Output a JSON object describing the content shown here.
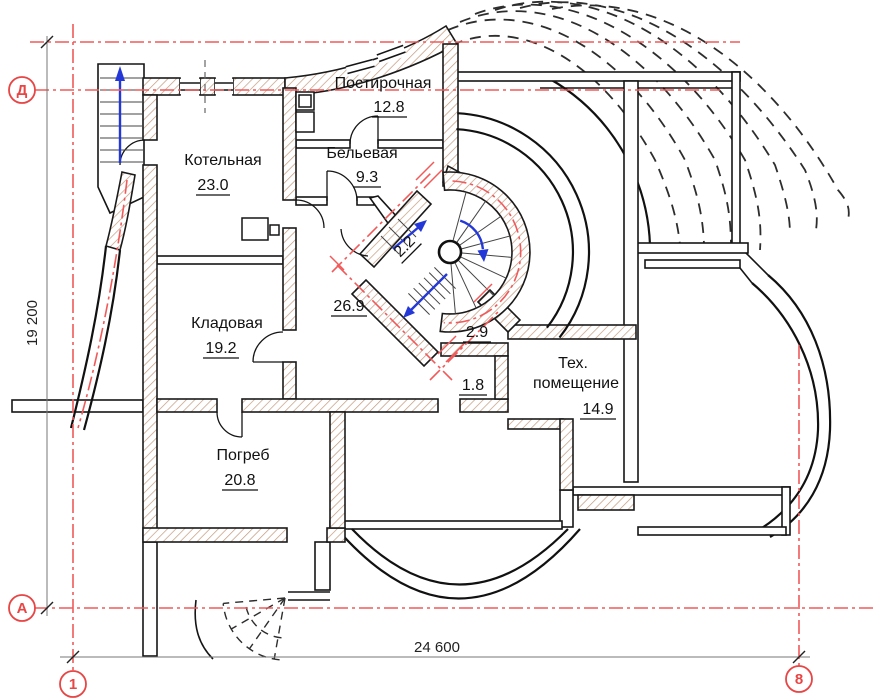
{
  "colors": {
    "axis_red": "#f15a5a",
    "hatch_brown": "#c49a7e",
    "wall_black": "#1a1a1a",
    "arrow_blue": "#2438d8"
  },
  "rooms": [
    {
      "name": "Котельная",
      "area": "23.0"
    },
    {
      "name": "Постирочная",
      "area": "12.8"
    },
    {
      "name": "Бельевая",
      "area": "9.3"
    },
    {
      "name": "Кладовая",
      "area": "19.2"
    },
    {
      "name": "Погреб",
      "area": "20.8"
    },
    {
      "name": "",
      "area": "26.9"
    },
    {
      "name_lines": [
        "Тех.",
        "помещение"
      ],
      "area": "14.9"
    },
    {
      "name": "",
      "area": "2.9"
    },
    {
      "name": "",
      "area": "1.8"
    },
    {
      "name": "",
      "area": "2.2"
    }
  ],
  "dimensions": {
    "horizontal": "24 600",
    "vertical": "19 200"
  },
  "axis_markers": {
    "row_top": "Д",
    "row_bottom": "А",
    "col_left": "1",
    "col_right": "8"
  }
}
